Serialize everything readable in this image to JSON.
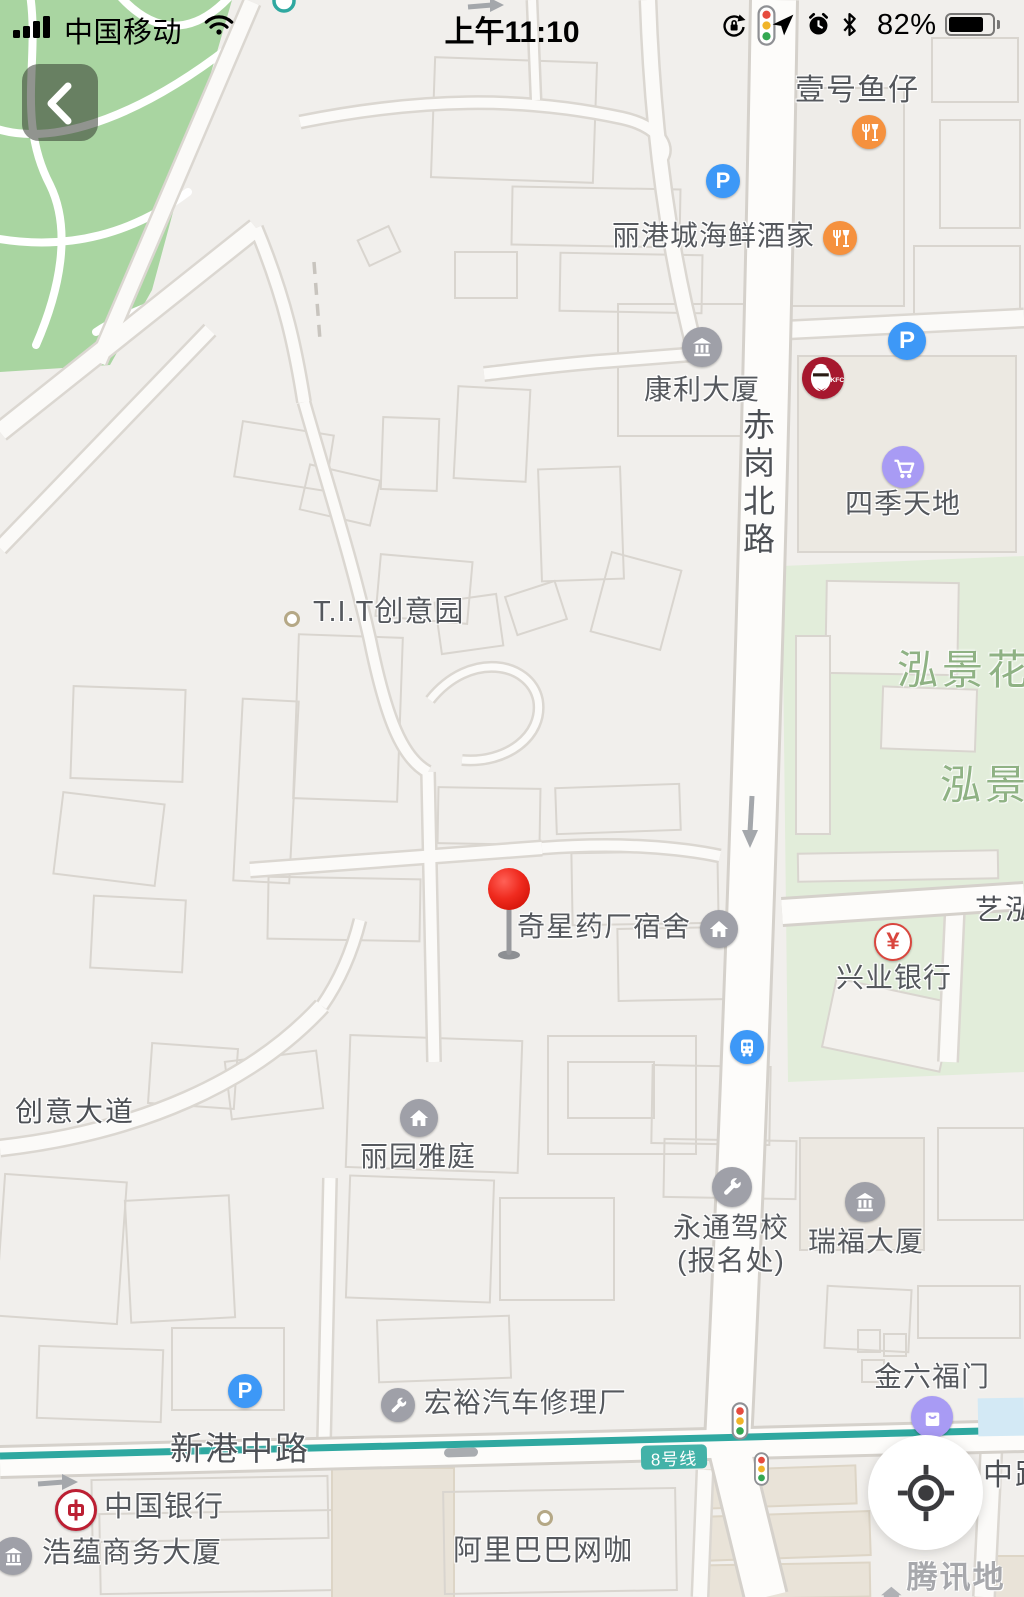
{
  "status_bar": {
    "carrier": "中国移动",
    "time": "上午11:10",
    "battery_percent": "82%"
  },
  "controls": {
    "back_button": "chevron-left",
    "locate_button": "crosshair"
  },
  "map": {
    "watermark": "腾讯地图",
    "metro_line_badge": "8号线",
    "glyphs": {
      "parking": "P",
      "yuan": "¥",
      "boc": "中"
    },
    "road_labels": {
      "chigang_north_road": "赤岗北路",
      "xingang_middle_road": "新港中路",
      "chuangyi_avenue": "创意大道",
      "zhong_lu_partial": "中路",
      "yihong_partial": "艺泓"
    },
    "area_labels": {
      "hongjing_garden_1": "泓景花",
      "hongjing_garden_2": "泓景"
    },
    "pois": {
      "yihao_yuzai": {
        "label": "壹号鱼仔",
        "icon": "restaurant-icon"
      },
      "ligangcheng_seafood_restaurant": {
        "label": "丽港城海鲜酒家",
        "icon": "restaurant-icon"
      },
      "kangli_building": {
        "label": "康利大厦",
        "icon": "building-icon"
      },
      "kfc": {
        "label": "KFC",
        "icon": "kfc-logo"
      },
      "siji_tiandi": {
        "label": "四季天地",
        "icon": "shopping-cart-icon"
      },
      "tit_creative_park": {
        "label": "T.I.T创意园",
        "icon": "dot-marker"
      },
      "qixing_pharma_dormitory": {
        "label": "奇星药厂宿舍",
        "icon": "house-icon"
      },
      "xingye_bank": {
        "label": "兴业银行",
        "icon": "bank-yuan-icon"
      },
      "liyuan_yating": {
        "label": "丽园雅庭",
        "icon": "house-icon"
      },
      "yongtong_driving_school": {
        "label_line1": "永通驾校",
        "label_line2": "(报名处)",
        "icon": "repair-icon"
      },
      "ruifu_building": {
        "label": "瑞福大厦",
        "icon": "building-icon"
      },
      "jinliufu_men": {
        "label": "金六福门",
        "icon": "shopping-bag-icon"
      },
      "hongyu_auto_repair": {
        "label": "宏裕汽车修理厂",
        "icon": "repair-icon"
      },
      "bank_of_china": {
        "label": "中国银行",
        "icon": "boc-logo"
      },
      "haoyun_business_building": {
        "label": "浩蕴商务大厦",
        "icon": "building-icon"
      },
      "alibaba_net_cafe": {
        "label": "阿里巴巴网咖",
        "icon": "dot-marker"
      }
    },
    "colors": {
      "restaurant": "#F5913E",
      "parking": "#3D98F7",
      "bus": "#3D98F7",
      "shopping": "#A89BF4",
      "generic_poi": "#9FA0A8",
      "bank_red": "#D9463E",
      "kfc_red": "#A6182E",
      "metro_teal": "#2FA8A0",
      "park_green": "#A9D5A1",
      "residential_green": "#E2EDDA",
      "pin_red": "#E8291D"
    }
  }
}
